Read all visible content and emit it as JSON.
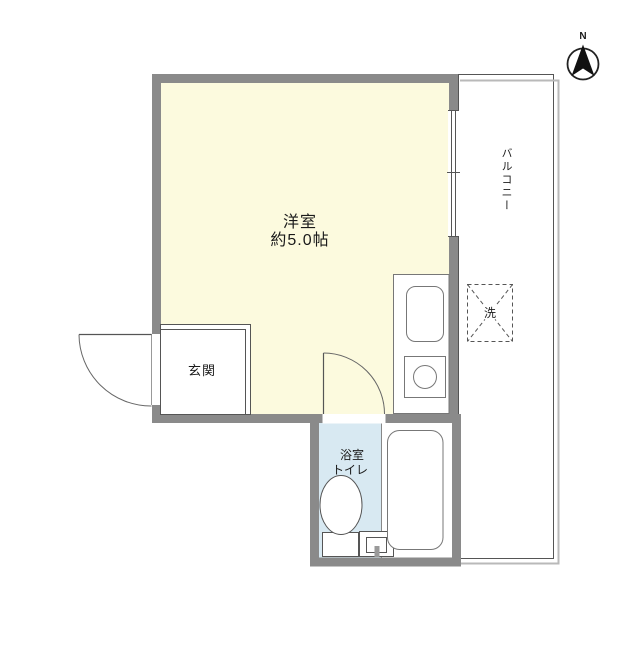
{
  "palette": {
    "wall": "#8a8a8a",
    "main_room_fill": "#fcfade",
    "bathroom_fill": "#d8e9f2",
    "outline": "#555555",
    "fixture_outline": "#777777",
    "balcony_rail": "#b9b9b9",
    "text": "#1a1a1a"
  },
  "compass": {
    "north_label": "N"
  },
  "rooms": {
    "main_room": {
      "name_label": "洋室",
      "size_label": "約5.0帖"
    },
    "balcony": {
      "label": "バルコニー"
    },
    "entrance": {
      "label": "玄関"
    },
    "bathroom": {
      "label_line1": "浴室",
      "label_line2": "トイレ"
    },
    "laundry_space": {
      "label": "洗"
    }
  }
}
